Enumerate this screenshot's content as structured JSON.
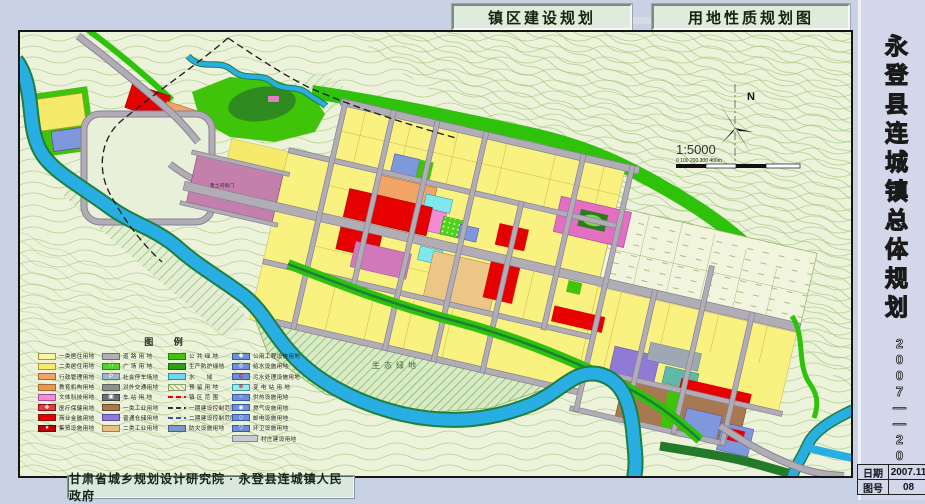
{
  "header": {
    "title_left": "镇区建设规划",
    "title_right": "用地性质规划图"
  },
  "side_panel": {
    "title_vertical": "永登县连城镇总体规划",
    "period_vertical": "2007——2020",
    "info_rows": [
      {
        "label": "日期",
        "value": "2007.11"
      },
      {
        "label": "图号",
        "value": "08"
      }
    ]
  },
  "footer": {
    "credit": "甘肃省城乡规划设计研究院 · 永登县连城镇人民政府"
  },
  "map": {
    "north_label": "N",
    "scale_text": "1:5000",
    "scale_ticks": "0     100    200    300   400m",
    "labels": {
      "historic_site": "鲁土司衙门",
      "eco_green": "生态绿地"
    },
    "colors": {
      "water": "#29AEE4",
      "public_green": "#3FC40A",
      "residential_yellow": "#F9F180",
      "commercial_red": "#E60000",
      "historic_mauve": "#C480AC",
      "road_gray": "#B0AEB4"
    },
    "legend": {
      "title": "图  例",
      "columns": [
        {
          "items": [
            {
              "label": "一类居住用地",
              "bg": "#FBF6A2",
              "br": "#A89A30"
            },
            {
              "label": "二类居住用地",
              "bg": "#F6EA6B",
              "br": "#A89A30"
            },
            {
              "label": "行政管理用地",
              "bg": "#F2A36A",
              "br": "#A06A30"
            },
            {
              "label": "教育机构用地",
              "bg": "#EE9454",
              "br": "#A06A30"
            },
            {
              "label": "文体科技用地",
              "bg": "#F28CD4",
              "br": "#A0509A"
            },
            {
              "label": "医疗保健用地",
              "bg": "#E43C3C",
              "br": "#8A1010",
              "sym": "✚",
              "symc": "#FFFFFF"
            },
            {
              "label": "商业金融用地",
              "bg": "#E60000",
              "br": "#8A1010"
            },
            {
              "label": "集贸设施用地",
              "bg": "#C00000",
              "br": "#700000",
              "sym": "●",
              "symc": "#FFFFFF"
            }
          ]
        },
        {
          "items": [
            {
              "label": "道 路 用 地",
              "bg": "#B0B0B0",
              "br": "#707070"
            },
            {
              "label": "广 场 用 地",
              "bg": "#55D22E",
              "br": "#2E8A12",
              "sym": "∷",
              "symc": "#FFFFFF"
            },
            {
              "label": "社会停车场地",
              "bg": "#9FB6C8",
              "br": "#5A7A96",
              "sym": "P",
              "symc": "#FFFFFF"
            },
            {
              "label": "对外交通用地",
              "bg": "#8F8F8F",
              "br": "#606060"
            },
            {
              "label": "车 站 用 地",
              "bg": "#6E6E78",
              "br": "#404048",
              "sym": "▣",
              "symc": "#FFFFFF"
            },
            {
              "label": "一类工业用地",
              "bg": "#A87850",
              "br": "#6E4A28"
            },
            {
              "label": "普通仓储用地",
              "bg": "#8F7AD8",
              "br": "#5A48A0"
            },
            {
              "label": "二类工业用地",
              "bg": "#E6C183",
              "br": "#A08040"
            }
          ]
        },
        {
          "items": [
            {
              "label": "公 共 绿 地",
              "bg": "#3FC40A",
              "br": "#1E8A00"
            },
            {
              "label": "生产防护绿地",
              "bg": "#2E9E1A",
              "br": "#186A0A"
            },
            {
              "label": "水　　域",
              "bg": "#6FD8F0",
              "br": "#2090B8"
            },
            {
              "label": "预 留 用 地",
              "bg": "#F1F5DE",
              "br": "#8AA060",
              "kind": "hatch"
            },
            {
              "label": "镇 区 范 围",
              "kind": "line",
              "line": "#E60000"
            },
            {
              "label": "一期建设控制范围",
              "kind": "line",
              "line": "#333333"
            },
            {
              "label": "二期建设控制范围",
              "kind": "line",
              "line": "#3355CC"
            },
            {
              "label": "防灾设施用地",
              "bg": "#8098C8",
              "br": "#4A6090"
            }
          ]
        },
        {
          "items": [
            {
              "label": "公用工程设施用地",
              "bg": "#6F8FD8",
              "br": "#3A5AA0",
              "sym": "◆",
              "symc": "#FFFFFF"
            },
            {
              "label": "给水设施用地",
              "bg": "#6F8FD8",
              "br": "#3A5AA0",
              "sym": "◎",
              "symc": "#FFFFFF"
            },
            {
              "label": "污水处理设施用地",
              "bg": "#6F8FD8",
              "br": "#3A5AA0",
              "sym": "⊙",
              "symc": "#E00000"
            },
            {
              "label": "变 电 站 用 地",
              "bg": "#9FE8EE",
              "br": "#3A9AA0",
              "sym": "⊗",
              "symc": "#E00000"
            },
            {
              "label": "供热设施用地",
              "bg": "#6F8FD8",
              "br": "#3A5AA0",
              "sym": "○",
              "symc": "#FFFFFF"
            },
            {
              "label": "燃气设施用地",
              "bg": "#6F8FD8",
              "br": "#3A5AA0",
              "sym": "◉",
              "symc": "#FFFFFF"
            },
            {
              "label": "邮电设施用地",
              "bg": "#6F8FD8",
              "br": "#3A5AA0",
              "sym": "◇",
              "symc": "#FFFFFF"
            },
            {
              "label": "环卫设施用地",
              "bg": "#6F8FD8",
              "br": "#3A5AA0",
              "sym": "▽",
              "symc": "#FFFFFF"
            },
            {
              "label": "村庄建设用地",
              "bg": "#C8CCD4",
              "br": "#808890",
              "wide": true
            }
          ]
        }
      ]
    }
  }
}
